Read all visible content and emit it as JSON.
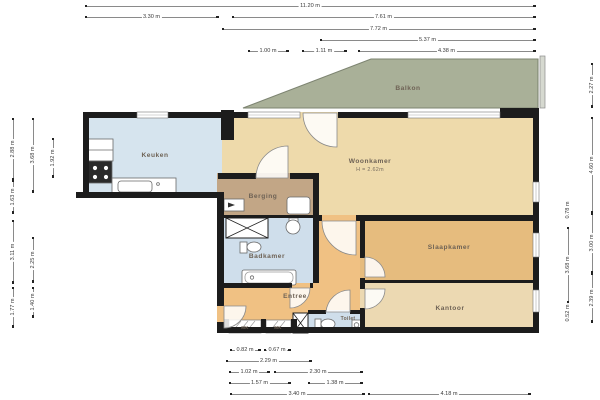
{
  "rooms": {
    "keuken": {
      "label": "Keuken"
    },
    "woonkamer": {
      "label": "Woonkamer",
      "note": "H = 2.62m"
    },
    "balkon": {
      "label": "Balkon"
    },
    "berging": {
      "label": "Berging"
    },
    "badkamer": {
      "label": "Badkamer"
    },
    "entree": {
      "label": "Entree"
    },
    "toilet": {
      "label": "Toilet"
    },
    "slaapkamer": {
      "label": "Slaapkamer"
    },
    "kantoor": {
      "label": "Kantoor"
    },
    "meterkast1": {
      "label": "MK"
    },
    "meterkast2": {
      "label": "MK"
    }
  },
  "colors": {
    "wall": "#1c1c1c",
    "keuken": "#d6e4ee",
    "badkamer": "#cfdeeb",
    "toilet": "#cfdeeb",
    "woonkamer": "#eedaab",
    "kantoor": "#ecd9b2",
    "slaapkamer": "#e6bc7e",
    "entree": "#f0c183",
    "berging": "#c2a686",
    "balkon": "#a9b098",
    "railing": "#d6d9d0",
    "fixture_stroke": "#6a6a6a"
  },
  "dims": {
    "top": [
      {
        "o": "h",
        "x": 85,
        "y": 6,
        "len": 450,
        "label": "11.20 m"
      },
      {
        "o": "h",
        "x": 85,
        "y": 17,
        "len": 133,
        "label": "3.30 m"
      },
      {
        "o": "h",
        "x": 232,
        "y": 17,
        "len": 303,
        "label": "7.61 m"
      },
      {
        "o": "h",
        "x": 222,
        "y": 29,
        "len": 313,
        "label": "7.72 m"
      },
      {
        "o": "h",
        "x": 320,
        "y": 40,
        "len": 215,
        "label": "5.37 m"
      },
      {
        "o": "h",
        "x": 248,
        "y": 51,
        "len": 40,
        "label": "1.00 m"
      },
      {
        "o": "h",
        "x": 302,
        "y": 51,
        "len": 44,
        "label": "1.11 m"
      },
      {
        "o": "h",
        "x": 358,
        "y": 51,
        "len": 177,
        "label": "4.38 m"
      }
    ],
    "bottom": [
      {
        "o": "h",
        "x": 230,
        "y": 350,
        "len": 30,
        "label": "0.82 m"
      },
      {
        "o": "h",
        "x": 264,
        "y": 350,
        "len": 26,
        "label": "0.67 m"
      },
      {
        "o": "h",
        "x": 226,
        "y": 361,
        "len": 85,
        "label": "2.29 m"
      },
      {
        "o": "h",
        "x": 229,
        "y": 372,
        "len": 40,
        "label": "1.02 m"
      },
      {
        "o": "h",
        "x": 274,
        "y": 372,
        "len": 88,
        "label": "2.30 m"
      },
      {
        "o": "h",
        "x": 229,
        "y": 383,
        "len": 61,
        "label": "1.57 m"
      },
      {
        "o": "h",
        "x": 308,
        "y": 383,
        "len": 54,
        "label": "1.38 m"
      },
      {
        "o": "h",
        "x": 230,
        "y": 394,
        "len": 134,
        "label": "3.40 m"
      },
      {
        "o": "h",
        "x": 368,
        "y": 394,
        "len": 162,
        "label": "4.18 m"
      }
    ],
    "left": [
      {
        "o": "v",
        "x": 13,
        "y": 118,
        "len": 62,
        "label": "2.88 m"
      },
      {
        "o": "v",
        "x": 13,
        "y": 180,
        "len": 33,
        "label": "1.63 m"
      },
      {
        "o": "v",
        "x": 13,
        "y": 220,
        "len": 63,
        "label": "3.11 m"
      },
      {
        "o": "v",
        "x": 13,
        "y": 287,
        "len": 40,
        "label": "1.77 m"
      },
      {
        "o": "v",
        "x": 33,
        "y": 118,
        "len": 74,
        "label": "3.68 m"
      },
      {
        "o": "v",
        "x": 33,
        "y": 237,
        "len": 45,
        "label": "2.25 m"
      },
      {
        "o": "v",
        "x": 33,
        "y": 287,
        "len": 30,
        "label": "1.40 m"
      },
      {
        "o": "v",
        "x": 53,
        "y": 138,
        "len": 39,
        "label": "1.92 m"
      }
    ],
    "right": [
      {
        "o": "v",
        "x": 568,
        "y": 202,
        "len": 16,
        "label": "0.78 m"
      },
      {
        "o": "v",
        "x": 568,
        "y": 227,
        "len": 76,
        "label": "3.68 m"
      },
      {
        "o": "v",
        "x": 568,
        "y": 303,
        "len": 19,
        "label": "0.52 m"
      },
      {
        "o": "v",
        "x": 592,
        "y": 63,
        "len": 44,
        "label": "2.27 m"
      },
      {
        "o": "v",
        "x": 592,
        "y": 117,
        "len": 96,
        "label": "4.60 m"
      },
      {
        "o": "v",
        "x": 592,
        "y": 213,
        "len": 60,
        "label": "3.00 m"
      },
      {
        "o": "v",
        "x": 592,
        "y": 273,
        "len": 49,
        "label": "2.39 m"
      }
    ]
  }
}
